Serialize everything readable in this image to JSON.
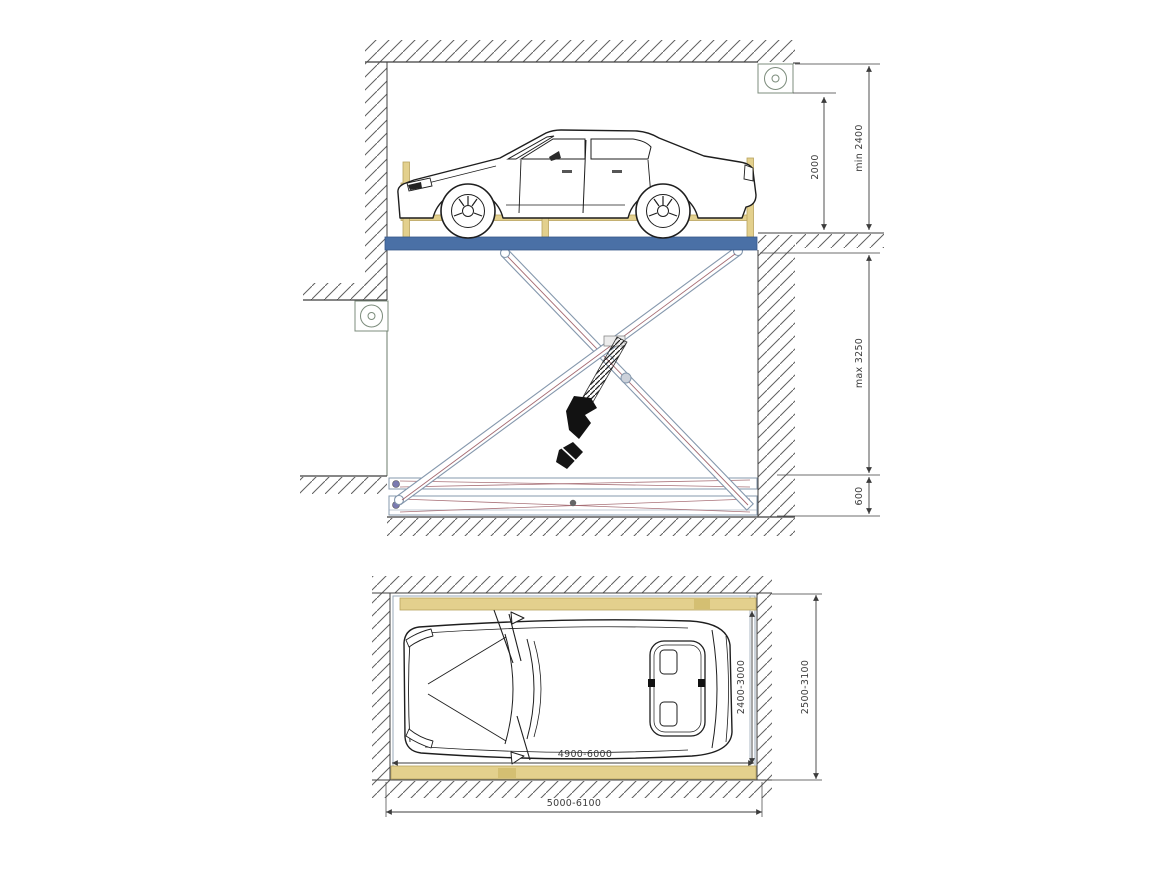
{
  "drawing": {
    "side_view": {
      "dim_clearance": "2000",
      "dim_headroom": "min 2400",
      "dim_travel": "max 3250",
      "dim_base": "600"
    },
    "plan_view": {
      "dim_platform_width": "2400-3000",
      "dim_pit_width": "2500-3100",
      "dim_platform_length": "4900-6000",
      "dim_pit_length": "5000-6100"
    },
    "icons": {
      "ceiling_fixture": "circle-in-square",
      "wall_fixture": "circle-in-square"
    }
  },
  "colors": {
    "platform_blue": "#4a70a6",
    "platform_blue_dark": "#38588a",
    "barrier_yellow": "#e3d08d",
    "barrier_yellow_dark": "#b8a35e",
    "steel_outline": "#8598ad",
    "brace_red": "#9b5a62",
    "hatch_gray": "#5f5f5f",
    "dim_gray": "#3c3c3c",
    "line_dark": "#3f3f3f",
    "fixture_green": "#7c8c7c"
  }
}
